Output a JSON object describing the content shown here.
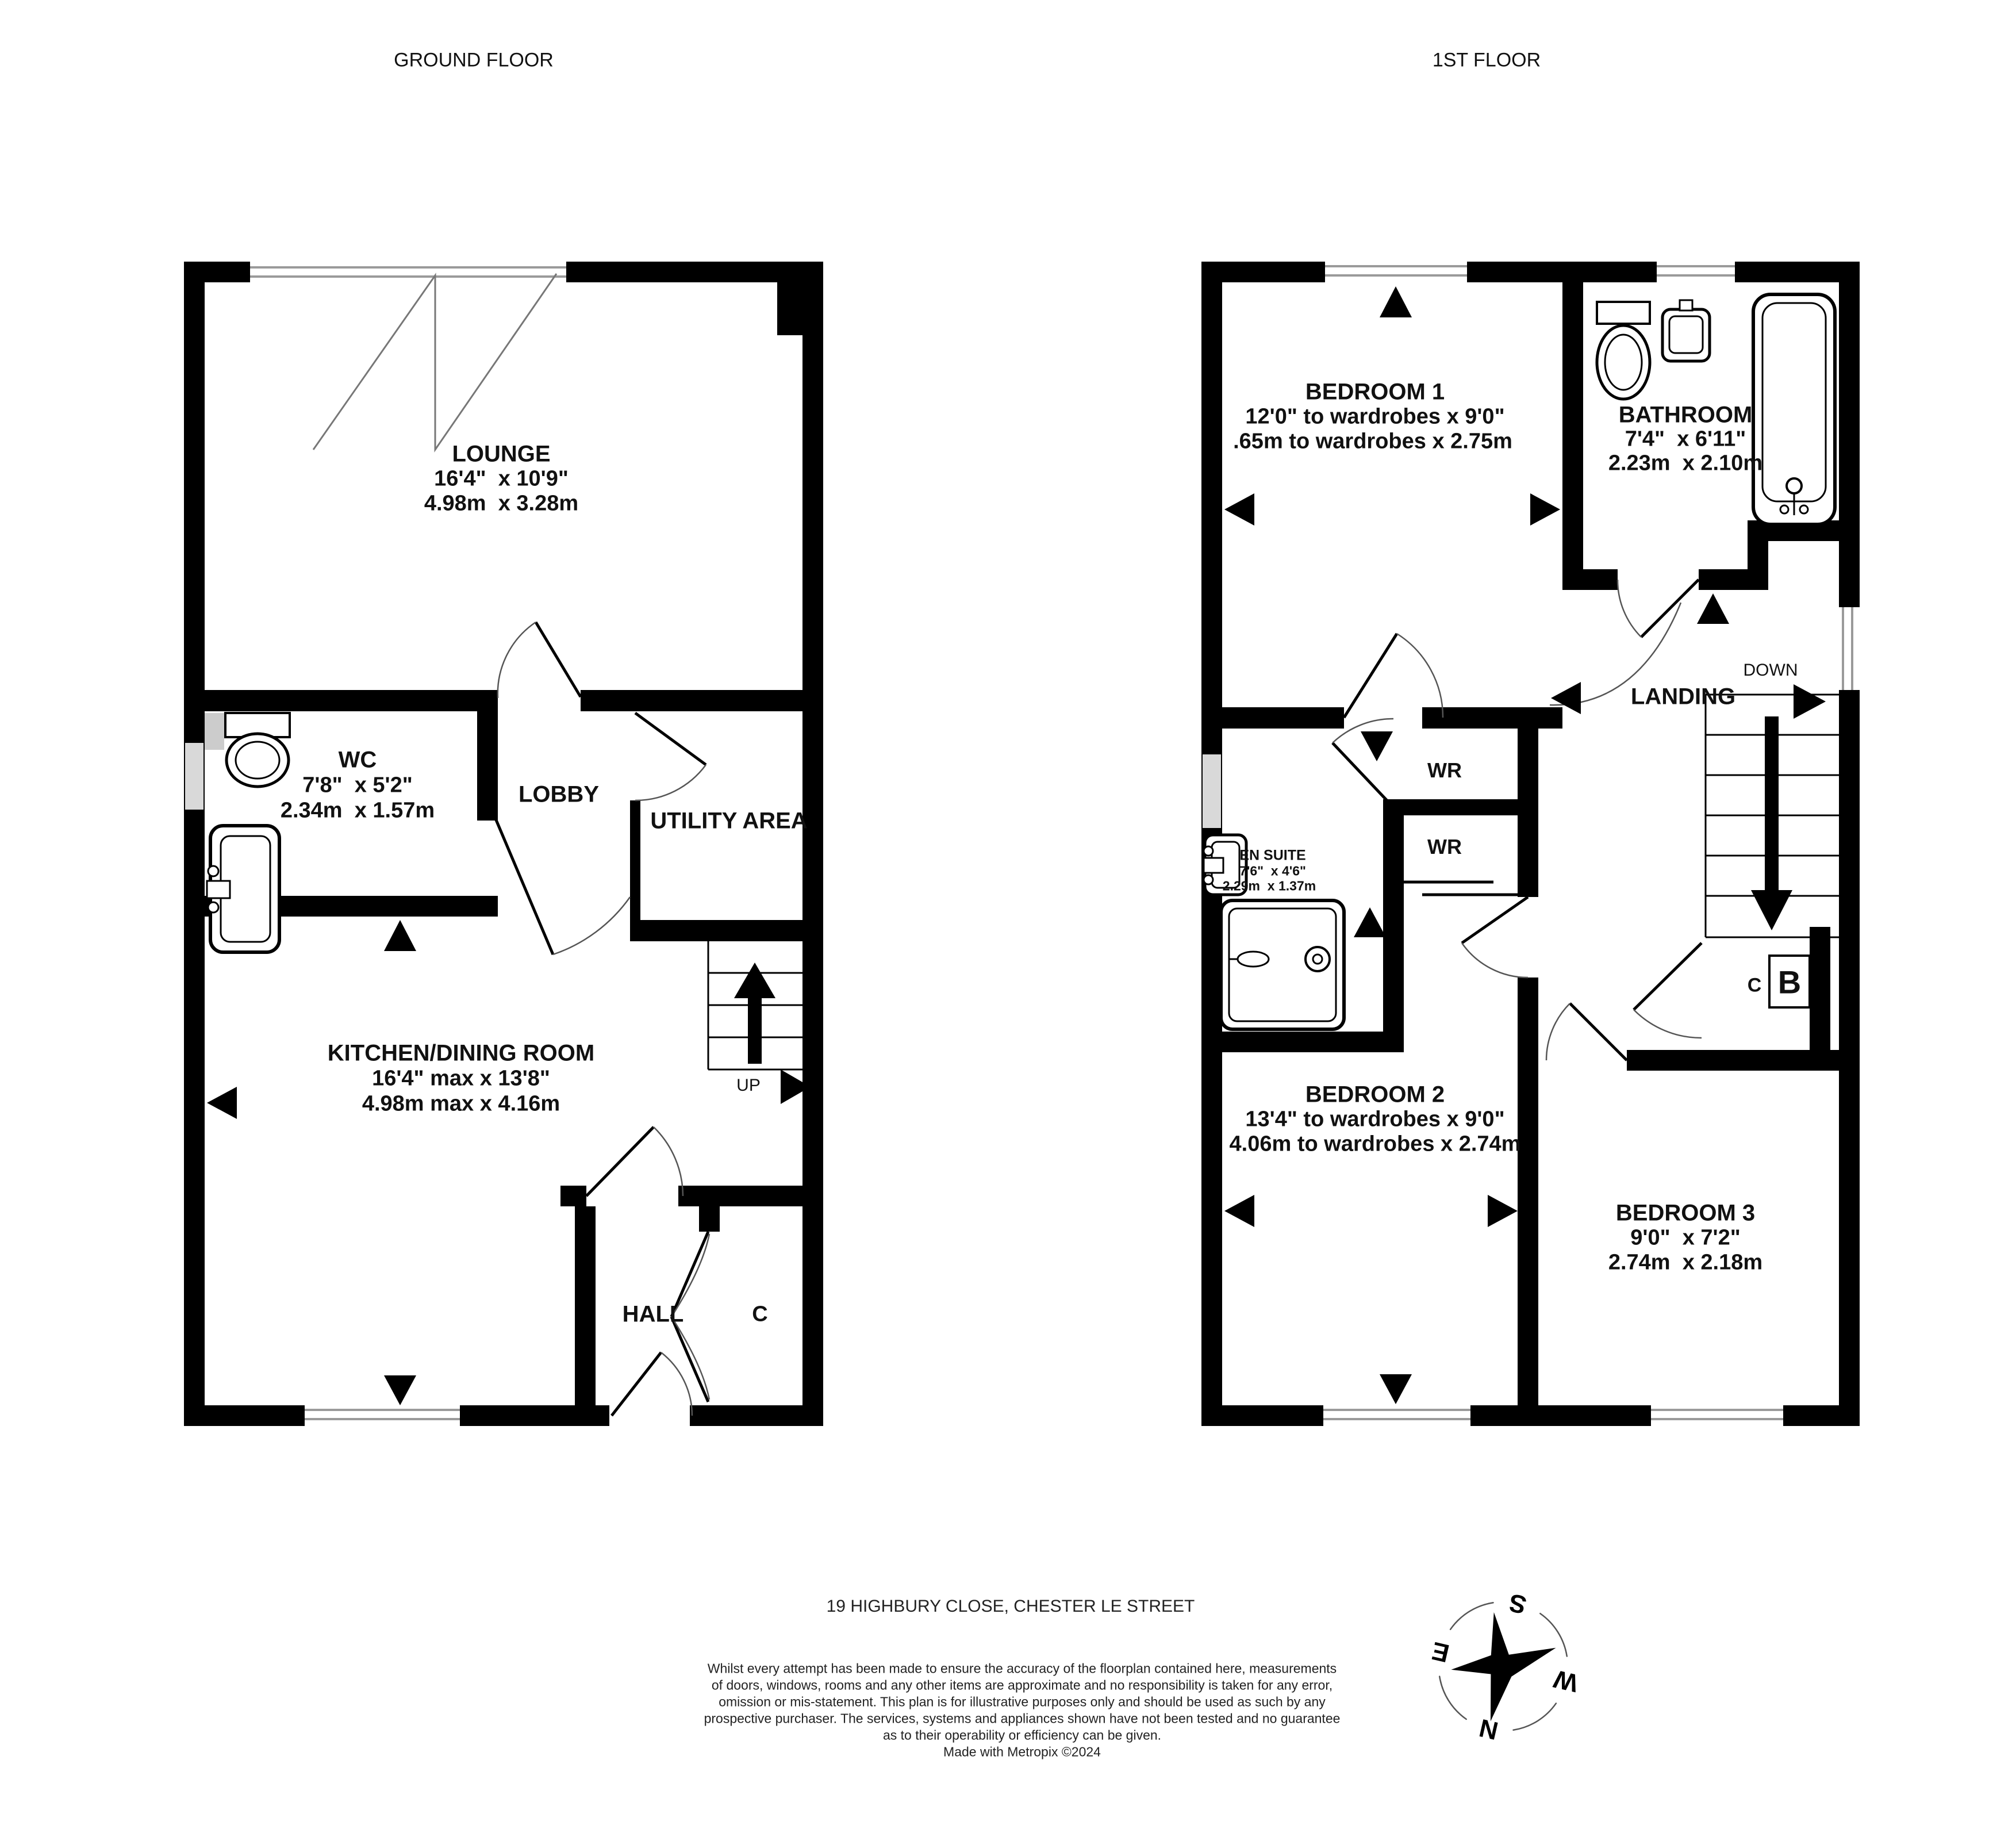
{
  "floors": {
    "ground": {
      "title": "GROUND FLOOR",
      "rooms": {
        "lounge": {
          "name": "LOUNGE",
          "imperial": "16'4\"  x 10'9\"",
          "metric": "4.98m  x 3.28m"
        },
        "wc": {
          "name": "WC",
          "imperial": "7'8\"  x 5'2\"",
          "metric": "2.34m  x 1.57m"
        },
        "lobby": {
          "name": "LOBBY"
        },
        "utility": {
          "name": "UTILITY AREA"
        },
        "kitchen": {
          "name": "KITCHEN/DINING ROOM",
          "imperial": "16'4\" max x 13'8\"",
          "metric": "4.98m max x 4.16m"
        },
        "hall": {
          "name": "HALL"
        },
        "cupboard": {
          "name": "C"
        }
      },
      "stairs_label": "UP"
    },
    "first": {
      "title": "1ST FLOOR",
      "rooms": {
        "bedroom1": {
          "name": "BEDROOM 1",
          "imperial": "12'0\" to wardrobes x 9'0\"",
          "metric": ".65m to wardrobes x 2.75m"
        },
        "bathroom": {
          "name": "BATHROOM",
          "imperial": "7'4\"  x 6'11\"",
          "metric": "2.23m  x 2.10m"
        },
        "landing": {
          "name": "LANDING"
        },
        "ensuite": {
          "name": "EN SUITE",
          "imperial": "7'6\"  x 4'6\"",
          "metric": "2.29m  x 1.37m"
        },
        "wr_top": {
          "name": "WR"
        },
        "wr_bottom": {
          "name": "WR"
        },
        "bedroom2": {
          "name": "BEDROOM 2",
          "imperial": "13'4\" to wardrobes x 9'0\"",
          "metric": "4.06m to wardrobes x 2.74m"
        },
        "bedroom3": {
          "name": "BEDROOM 3",
          "imperial": "9'0\"  x 7'2\"",
          "metric": "2.74m  x 2.18m"
        },
        "cupboard": {
          "name": "C"
        },
        "boiler": {
          "name": "B"
        }
      },
      "stairs_label": "DOWN"
    }
  },
  "compass": {
    "n": "N",
    "e": "E",
    "s": "S",
    "w": "W"
  },
  "footer": {
    "address": "19 HIGHBURY CLOSE, CHESTER LE STREET",
    "disclaimer_lines": [
      "Whilst every attempt has been made to ensure the accuracy of the floorplan contained here, measurements",
      "of doors, windows, rooms and any other items are approximate and no responsibility is taken for any error,",
      "omission or mis-statement. This plan is for illustrative purposes only and should be used as such by any",
      "prospective purchaser. The services, systems and appliances shown have not been tested and no guarantee",
      "as to their operability or efficiency can be given.",
      "Made with Metropix ©2024"
    ]
  },
  "colors": {
    "wall": "#000000",
    "window_line": "#9a9a9a",
    "background": "#ffffff"
  }
}
